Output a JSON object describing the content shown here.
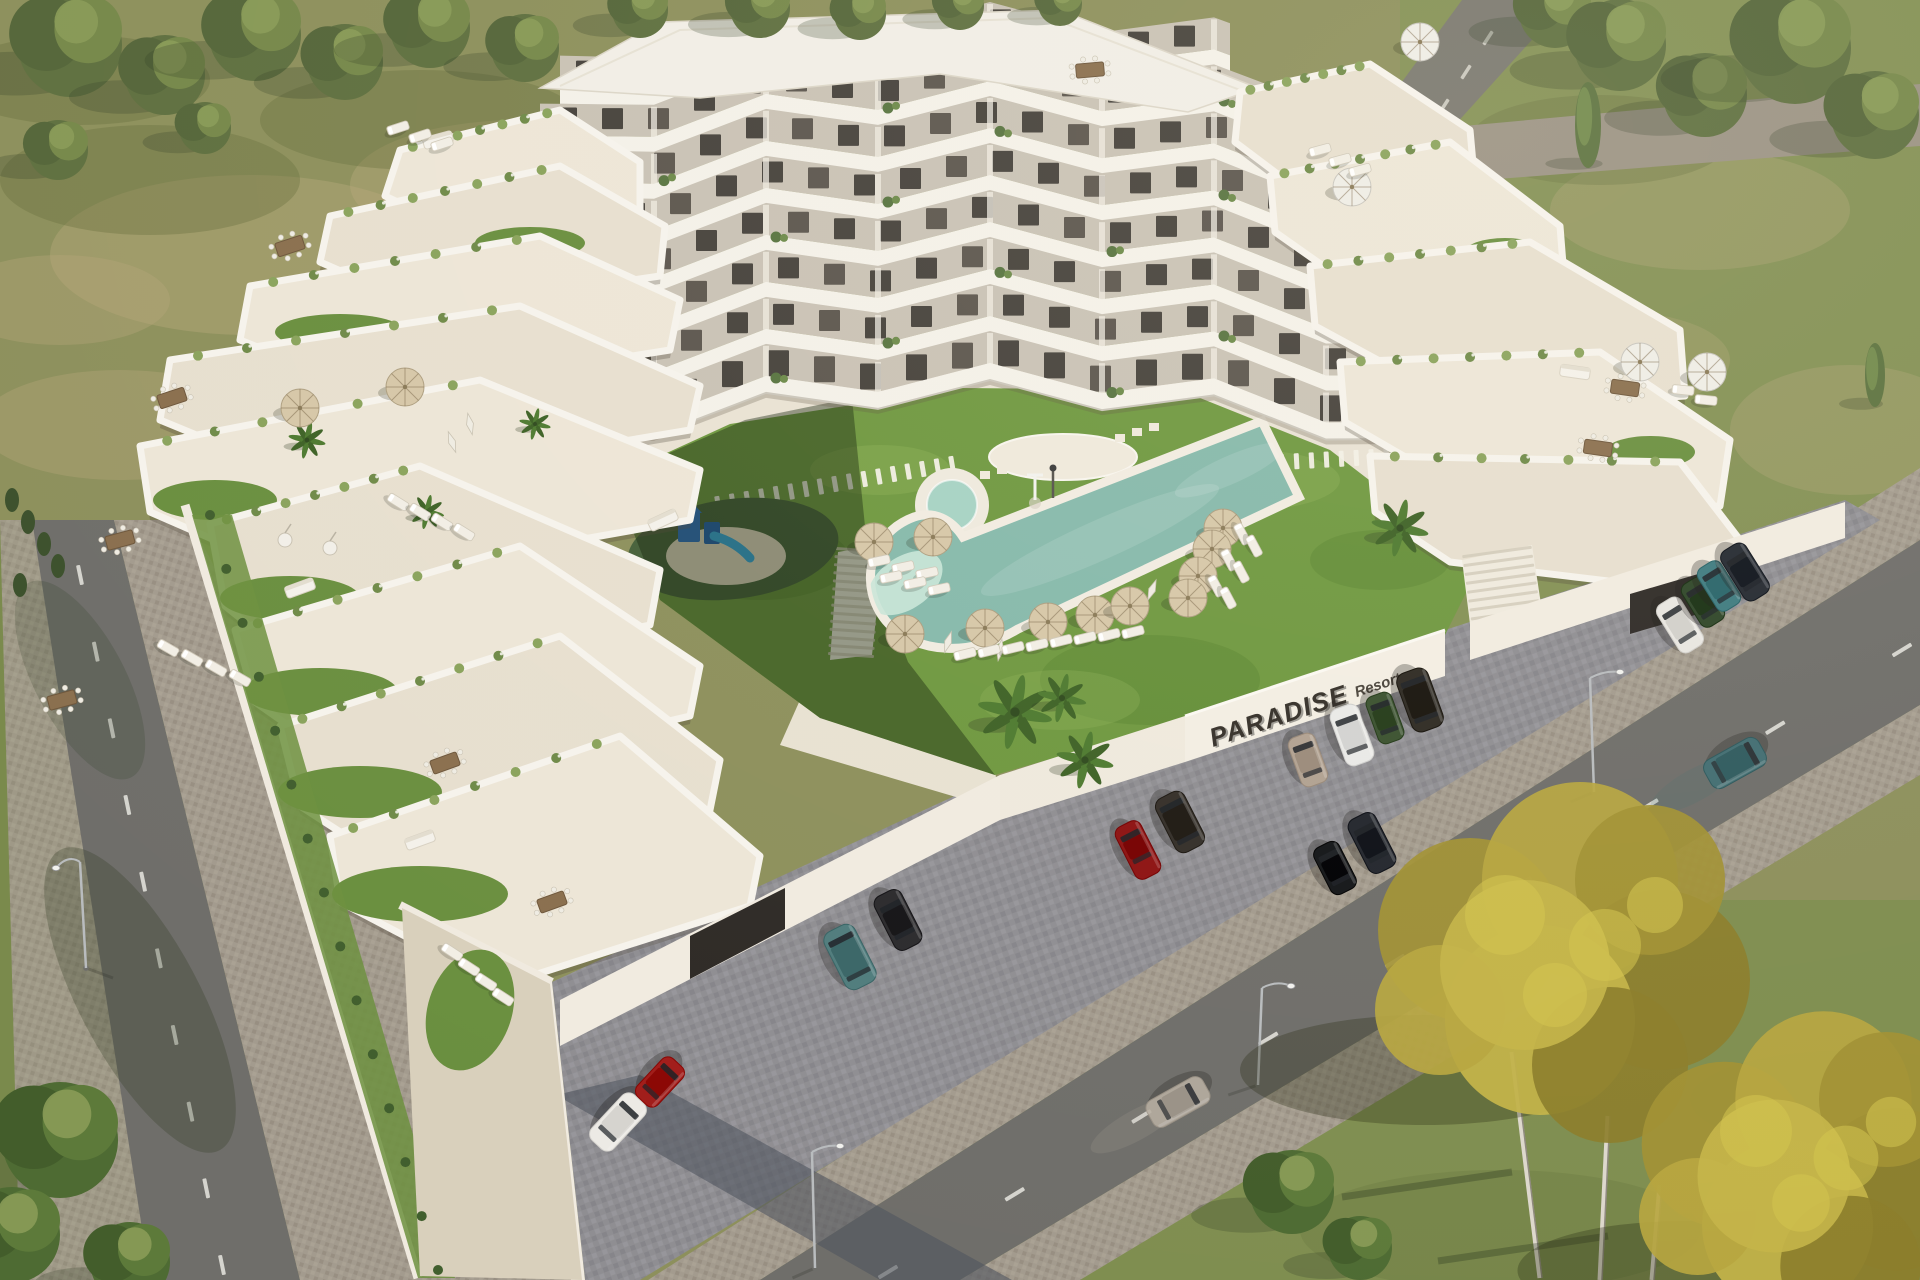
{
  "meta": {
    "title": "Aerial 3D architectural rendering of a terraced apartment resort complex",
    "view": "aerial-oblique",
    "scene_type": "architectural-visualization"
  },
  "sign": {
    "primary": "PARADISE",
    "secondary": "Resort",
    "color": "#35302a"
  },
  "palette": {
    "grass_field": "#8d905c",
    "grass_right": "#7e9150",
    "lawn": "#6f9840",
    "lawn_shadow": "rgba(18,34,10,0.42)",
    "pool_water": "#86b9ab",
    "pool_shallow": "#c9e5d8",
    "pool_rim": "#f1ece1",
    "building_white": "#f4f1e9",
    "facade": "#c9c2b5",
    "window": "#46423c",
    "window_alt": "#5c564e",
    "terrace_floor_a": "#ede6d7",
    "terrace_floor_b": "#e7dfcf",
    "road": "#6f6e6a",
    "sidewalk": "#a39b8e",
    "parking": "#8f8e92",
    "wall": "#f1ebe0",
    "umbrella_tan": "#d6c7a8",
    "umbrella_white": "#efede6",
    "lounger": "#f2eee5",
    "playground_turf": "#46603a",
    "playground_blue": "#2b6fc4",
    "playground_slide": "#35a8e0",
    "yellow_tree": "#b1a135",
    "green_tree": "#5f7040"
  },
  "counts": {
    "visible_floors": 8,
    "pools": 2,
    "umbrellas_tan": 13,
    "umbrellas_white": 4,
    "umbrellas_closed": 5,
    "sun_loungers": 40,
    "cars_parked": 16,
    "cars_driving": 2,
    "street_lamps": 4,
    "playgrounds": 1
  },
  "objects": {
    "umbrellas_tan": [
      {
        "x": 874,
        "y": 542
      },
      {
        "x": 933,
        "y": 537
      },
      {
        "x": 905,
        "y": 634
      },
      {
        "x": 985,
        "y": 628
      },
      {
        "x": 1048,
        "y": 622
      },
      {
        "x": 1095,
        "y": 615
      },
      {
        "x": 1130,
        "y": 606
      },
      {
        "x": 1223,
        "y": 528
      },
      {
        "x": 1212,
        "y": 549
      },
      {
        "x": 1198,
        "y": 576
      },
      {
        "x": 1188,
        "y": 598
      },
      {
        "x": 300,
        "y": 408
      },
      {
        "x": 405,
        "y": 387
      }
    ],
    "umbrellas_white": [
      {
        "x": 1420,
        "y": 42
      },
      {
        "x": 1352,
        "y": 187
      },
      {
        "x": 1640,
        "y": 362
      },
      {
        "x": 1707,
        "y": 372
      }
    ],
    "umbrellas_closed": [
      {
        "x": 948,
        "y": 642,
        "rot": 18
      },
      {
        "x": 1000,
        "y": 650,
        "rot": 10
      },
      {
        "x": 1152,
        "y": 590,
        "rot": 22
      },
      {
        "x": 470,
        "y": 424,
        "rot": -12
      },
      {
        "x": 452,
        "y": 442,
        "rot": -20
      }
    ],
    "loungers": [
      {
        "x": 965,
        "y": 654,
        "rot": -14
      },
      {
        "x": 989,
        "y": 651,
        "rot": -14
      },
      {
        "x": 1013,
        "y": 648,
        "rot": -14
      },
      {
        "x": 1037,
        "y": 645,
        "rot": -14
      },
      {
        "x": 1061,
        "y": 641,
        "rot": -14
      },
      {
        "x": 1085,
        "y": 638,
        "rot": -14
      },
      {
        "x": 1109,
        "y": 635,
        "rot": -14
      },
      {
        "x": 1133,
        "y": 632,
        "rot": -14
      },
      {
        "x": 879,
        "y": 561,
        "rot": -12
      },
      {
        "x": 903,
        "y": 567,
        "rot": -12
      },
      {
        "x": 927,
        "y": 573,
        "rot": -12
      },
      {
        "x": 891,
        "y": 577,
        "rot": -12
      },
      {
        "x": 915,
        "y": 583,
        "rot": -12
      },
      {
        "x": 939,
        "y": 589,
        "rot": -12
      },
      {
        "x": 1242,
        "y": 534,
        "rot": 62
      },
      {
        "x": 1254,
        "y": 546,
        "rot": 62
      },
      {
        "x": 1229,
        "y": 560,
        "rot": 62
      },
      {
        "x": 1241,
        "y": 572,
        "rot": 62
      },
      {
        "x": 1216,
        "y": 586,
        "rot": 62
      },
      {
        "x": 1228,
        "y": 598,
        "rot": 62
      },
      {
        "x": 398,
        "y": 502,
        "rot": 32
      },
      {
        "x": 420,
        "y": 512,
        "rot": 32
      },
      {
        "x": 442,
        "y": 522,
        "rot": 32
      },
      {
        "x": 464,
        "y": 532,
        "rot": 32
      },
      {
        "x": 168,
        "y": 648,
        "rot": 30
      },
      {
        "x": 192,
        "y": 658,
        "rot": 30
      },
      {
        "x": 216,
        "y": 668,
        "rot": 30
      },
      {
        "x": 240,
        "y": 678,
        "rot": 30
      },
      {
        "x": 398,
        "y": 128,
        "rot": -18
      },
      {
        "x": 420,
        "y": 136,
        "rot": -18
      },
      {
        "x": 442,
        "y": 144,
        "rot": -18
      },
      {
        "x": 1320,
        "y": 150,
        "rot": -15
      },
      {
        "x": 1340,
        "y": 160,
        "rot": -15
      },
      {
        "x": 1360,
        "y": 170,
        "rot": -15
      },
      {
        "x": 1683,
        "y": 390,
        "rot": 6
      },
      {
        "x": 1706,
        "y": 400,
        "rot": 6
      },
      {
        "x": 452,
        "y": 952,
        "rot": 33
      },
      {
        "x": 469,
        "y": 967,
        "rot": 33
      },
      {
        "x": 486,
        "y": 982,
        "rot": 33
      },
      {
        "x": 503,
        "y": 997,
        "rot": 33
      }
    ],
    "cars": [
      {
        "x": 850,
        "y": 957,
        "rot": 63,
        "color": "#507c7d",
        "kind": "suv",
        "len": 64,
        "wid": 34,
        "moving": false
      },
      {
        "x": 898,
        "y": 920,
        "rot": 63,
        "color": "#2b2a2d",
        "kind": "sedan",
        "len": 60,
        "wid": 30,
        "moving": false
      },
      {
        "x": 1138,
        "y": 850,
        "rot": 63,
        "color": "#8d1212",
        "kind": "sports",
        "len": 58,
        "wid": 28,
        "moving": false
      },
      {
        "x": 1180,
        "y": 822,
        "rot": 63,
        "color": "#342f29",
        "kind": "suv",
        "len": 60,
        "wid": 32,
        "moving": false
      },
      {
        "x": 1335,
        "y": 868,
        "rot": 63,
        "color": "#141619",
        "kind": "hatch",
        "len": 52,
        "wid": 28,
        "moving": false
      },
      {
        "x": 1372,
        "y": 843,
        "rot": 63,
        "color": "#23262d",
        "kind": "sedan",
        "len": 60,
        "wid": 30,
        "moving": false
      },
      {
        "x": 1308,
        "y": 760,
        "rot": 70,
        "color": "#b1a191",
        "kind": "hatch",
        "len": 52,
        "wid": 28,
        "moving": false
      },
      {
        "x": 1352,
        "y": 735,
        "rot": 70,
        "color": "#e9e9e7",
        "kind": "sedan",
        "len": 60,
        "wid": 30,
        "moving": false
      },
      {
        "x": 1385,
        "y": 718,
        "rot": 70,
        "color": "#3a512f",
        "kind": "hatch",
        "len": 50,
        "wid": 27,
        "moving": false
      },
      {
        "x": 1420,
        "y": 700,
        "rot": 70,
        "color": "#2e2a23",
        "kind": "suv",
        "len": 62,
        "wid": 33,
        "moving": false
      },
      {
        "x": 618,
        "y": 1122,
        "rot": 133,
        "color": "#eceae5",
        "kind": "sedan",
        "len": 62,
        "wid": 30,
        "moving": false
      },
      {
        "x": 660,
        "y": 1082,
        "rot": 133,
        "color": "#a11d1a",
        "kind": "hatch",
        "len": 52,
        "wid": 28,
        "moving": false
      },
      {
        "x": 1680,
        "y": 625,
        "rot": 58,
        "color": "#e8e6e1",
        "kind": "sedan",
        "len": 56,
        "wid": 28,
        "moving": false
      },
      {
        "x": 1703,
        "y": 602,
        "rot": 58,
        "color": "#2f4629",
        "kind": "hatch",
        "len": 50,
        "wid": 27,
        "moving": false
      },
      {
        "x": 1719,
        "y": 586,
        "rot": 58,
        "color": "#3f7b80",
        "kind": "hatch",
        "len": 50,
        "wid": 27,
        "moving": false
      },
      {
        "x": 1745,
        "y": 572,
        "rot": 58,
        "color": "#252a32",
        "kind": "sedan",
        "len": 58,
        "wid": 29,
        "moving": false
      },
      {
        "x": 1178,
        "y": 1102,
        "rot": 151,
        "color": "#b7aea1",
        "kind": "sedan",
        "len": 64,
        "wid": 30,
        "moving": true
      },
      {
        "x": 1735,
        "y": 763,
        "rot": 151,
        "color": "#3e6f74",
        "kind": "suv",
        "len": 62,
        "wid": 32,
        "moving": true
      }
    ],
    "lamps": [
      {
        "x": 815,
        "y": 1268,
        "px": 812,
        "py": 1152,
        "ax": 840,
        "ay": 1146
      },
      {
        "x": 1258,
        "y": 1085,
        "px": 1262,
        "py": 988,
        "ax": 1291,
        "ay": 986
      },
      {
        "x": 1594,
        "y": 792,
        "px": 1590,
        "py": 678,
        "ax": 1620,
        "ay": 672
      },
      {
        "x": 86,
        "y": 968,
        "px": 80,
        "py": 862,
        "ax": 56,
        "ay": 868
      }
    ],
    "tables": [
      {
        "x": 172,
        "y": 398,
        "rot": -18
      },
      {
        "x": 120,
        "y": 540,
        "rot": -15
      },
      {
        "x": 290,
        "y": 246,
        "rot": -18
      },
      {
        "x": 445,
        "y": 763,
        "rot": -20
      },
      {
        "x": 552,
        "y": 902,
        "rot": -20
      },
      {
        "x": 1090,
        "y": 70,
        "rot": -5
      },
      {
        "x": 1625,
        "y": 388,
        "rot": 8
      },
      {
        "x": 1598,
        "y": 448,
        "rot": 8
      },
      {
        "x": 62,
        "y": 700,
        "rot": -15
      }
    ],
    "sofas": [
      {
        "x": 438,
        "y": 140,
        "rot": -15
      },
      {
        "x": 300,
        "y": 588,
        "rot": -20
      },
      {
        "x": 420,
        "y": 840,
        "rot": -20
      },
      {
        "x": 1575,
        "y": 372,
        "rot": 8
      },
      {
        "x": 663,
        "y": 520,
        "rot": -25
      }
    ],
    "egg_chairs": [
      {
        "x": 285,
        "y": 540
      },
      {
        "x": 330,
        "y": 548
      }
    ],
    "palms": [
      {
        "x": 307,
        "y": 440,
        "r": 13
      },
      {
        "x": 427,
        "y": 512,
        "r": 12
      },
      {
        "x": 535,
        "y": 424,
        "r": 11
      },
      {
        "x": 1015,
        "y": 712,
        "r": 26
      },
      {
        "x": 1085,
        "y": 760,
        "r": 20
      },
      {
        "x": 1062,
        "y": 698,
        "r": 17
      },
      {
        "x": 1400,
        "y": 528,
        "r": 20
      }
    ],
    "trees_back": [
      {
        "x": 70,
        "y": 45,
        "r": 52
      },
      {
        "x": 165,
        "y": 75,
        "r": 40
      },
      {
        "x": 255,
        "y": 35,
        "r": 46
      },
      {
        "x": 345,
        "y": 62,
        "r": 38
      },
      {
        "x": 430,
        "y": 28,
        "r": 40
      },
      {
        "x": 525,
        "y": 48,
        "r": 34
      },
      {
        "x": 58,
        "y": 150,
        "r": 30
      },
      {
        "x": 205,
        "y": 128,
        "r": 26
      },
      {
        "x": 640,
        "y": 10,
        "r": 28
      },
      {
        "x": 760,
        "y": 8,
        "r": 30
      },
      {
        "x": 860,
        "y": 14,
        "r": 26
      },
      {
        "x": 960,
        "y": 6,
        "r": 24
      },
      {
        "x": 1060,
        "y": 4,
        "r": 22
      },
      {
        "x": 1555,
        "y": 12,
        "r": 36
      },
      {
        "x": 1620,
        "y": 45,
        "r": 46
      },
      {
        "x": 1705,
        "y": 95,
        "r": 42
      },
      {
        "x": 1795,
        "y": 48,
        "r": 56
      },
      {
        "x": 1875,
        "y": 115,
        "r": 44
      }
    ],
    "trees_front": [
      {
        "x": 60,
        "y": 1140,
        "r": 58
      },
      {
        "x": 12,
        "y": 1235,
        "r": 48
      },
      {
        "x": 130,
        "y": 1262,
        "r": 40
      },
      {
        "x": 1292,
        "y": 1192,
        "r": 42
      },
      {
        "x": 1360,
        "y": 1248,
        "r": 32
      }
    ],
    "poplars": [
      {
        "x": 1588,
        "y": 125,
        "h": 86,
        "w": 26
      },
      {
        "x": 1875,
        "y": 375,
        "h": 64,
        "w": 20
      }
    ],
    "yellow_trees": [
      {
        "x": 1565,
        "y": 975,
        "s": 1.0
      },
      {
        "x": 1810,
        "y": 1185,
        "s": 0.9
      }
    ]
  }
}
